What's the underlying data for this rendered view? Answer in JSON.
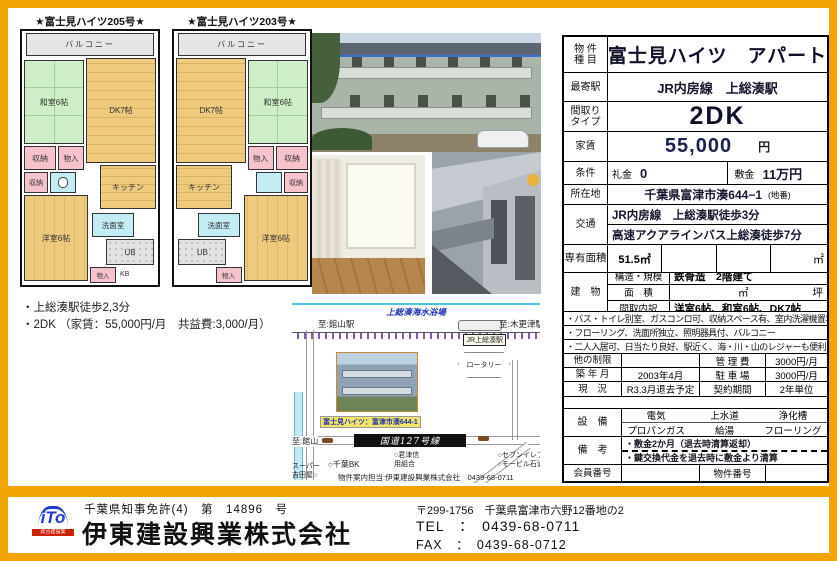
{
  "colors": {
    "frame": "#F2A405",
    "tatami": "#CDEEC6",
    "wood": "#EECA7E",
    "closet_pink": "#F6C3CD",
    "water_cyan": "#C4ECF4",
    "accent_navy": "#1B2050",
    "map_road_banner": "#111111",
    "caption_yellow": "#F2E468"
  },
  "floorplans": {
    "left_title": "★富士見ハイツ205号★",
    "right_title": "★富士見ハイツ203号★",
    "rooms": {
      "balcony": "バルコニー",
      "washitsu": "和室6帖",
      "dk": "DK7帖",
      "kitchen": "キッチン",
      "closet1": "収納",
      "monoire1": "物入",
      "closet2": "収納",
      "yoshitsu": "洋室6帖",
      "senmen": "洗面室",
      "ub": "UB",
      "monoire2": "物入",
      "kb": "KB"
    },
    "notes": [
      "・上総湊駅徒歩2,3分",
      "・2DK （家賃：55,000円/月　共益費:3,000/月）"
    ]
  },
  "map": {
    "beach": "上総湊海水浴場",
    "to_left_station": "至:館山駅",
    "to_right_station": "至:木更津駅",
    "station_label": "JR上総湊駅",
    "rotary": "ロータリー",
    "inset_caption": "富士見ハイツ：富津市湊644-1",
    "route_banner": "国道127号線",
    "to_tateyama": "至:館山",
    "poi_shinkumi": "○君津信\n用組合",
    "poi_bank": "○千葉BK",
    "poi_super": "スーパー\n吉田屋○",
    "poi_right": "○セブンイレブン\n○モービル石油GS",
    "agent_line": "物件案内担当:伊東建設興業株式会社　0439-68-0711"
  },
  "table": {
    "r1": {
      "label1": "物 件",
      "label2": "種 目",
      "value": "富士見ハイツ　アパート"
    },
    "r2": {
      "label": "最寄駅",
      "value": "JR内房線　上総湊駅"
    },
    "r3": {
      "label1": "間取り",
      "label2": "タイプ",
      "value": "2DK"
    },
    "r4": {
      "label": "家賃",
      "value": "55,000",
      "unit": "円"
    },
    "r5": {
      "label": "条件",
      "k1": "礼金",
      "v1": "0",
      "k2": "敷金",
      "v2": "11万円"
    },
    "r6": {
      "label": "所在地",
      "value": "千葉県富津市湊644−1",
      "note": "(地番)"
    },
    "r7": {
      "label": "交通",
      "line1": "JR内房線　上総湊駅徒歩3分",
      "line2": "高速アクアラインバス上総湊徒歩7分"
    },
    "r8": {
      "label": "専有面積",
      "value": "51.5㎡",
      "unit": "㎡"
    },
    "r9": {
      "label": "建　物",
      "k1": "構造・規模",
      "v1": "鉄骨造　2階建て",
      "k2": "面　積",
      "v2_unit1": "㎡",
      "v2_unit2": "坪",
      "k3": "間取内訳",
      "v3": "洋室6帖、和室6帖、DK7帖"
    },
    "notes": [
      "・バス・トイレ別室、ガスコンロ可、収納スペース有、室内洗濯機置場",
      "・フローリング、洗面所独立、照明器具付、バルコニー",
      "・二人入居可、日当たり良好、駅近く、海・川・山のレジャーも便利"
    ],
    "r11": {
      "label": "他の制限",
      "value": "",
      "label2": "管 理 費",
      "value2": "3000円/月"
    },
    "r12": {
      "label": "築 年 月",
      "value": "2003年4月",
      "label2": "駐 車 場",
      "value2": "3000円/月"
    },
    "r13": {
      "label": "現　況",
      "value": "R3.3月退去予定",
      "label2": "契約期間",
      "value2": "2年単位"
    },
    "r15": {
      "label": "設　備",
      "cells": [
        "電気",
        "上水道",
        "浄化槽",
        "プロパンガス",
        "給湯",
        "フローリング"
      ]
    },
    "r16": {
      "label": "備　考",
      "line1": "・敷金2か月（退去時清算返却）",
      "line2": "・鍵交換代金を退去時に敷金より清算"
    },
    "r17": {
      "label": "会員番号",
      "value": "",
      "label2": "物件番号",
      "value2": ""
    }
  },
  "footer": {
    "logo_text": "iTo",
    "logo_band": "総合建設業",
    "license": "千葉県知事免許(4)　第　14896　号",
    "company": "伊東建設興業株式会社",
    "postal": "〒299-1756　千葉県富津市六野12番地の2",
    "tel": "TEL　：　0439-68-0711",
    "fax": "FAX　：　0439-68-0712"
  }
}
